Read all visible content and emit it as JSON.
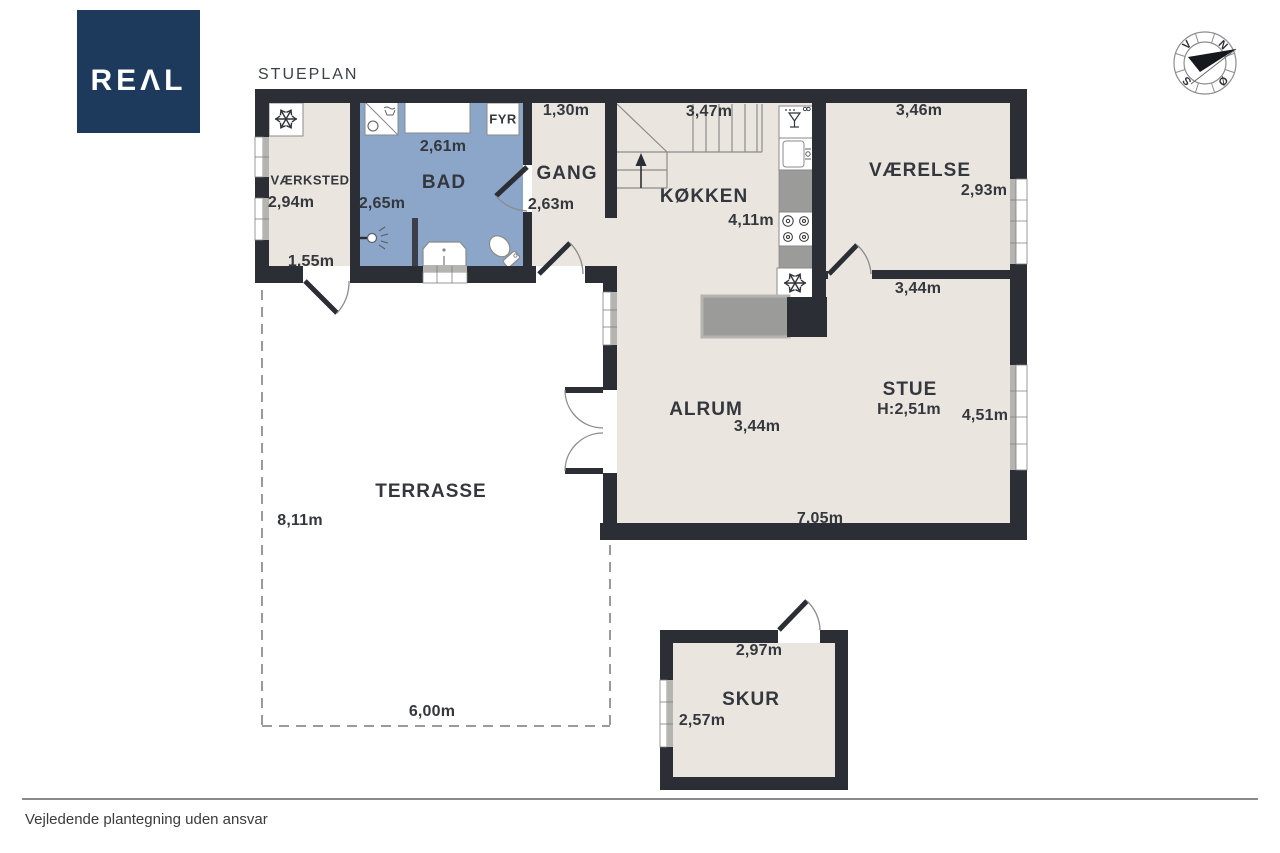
{
  "header": {
    "logo_text": "REΛL",
    "title": "STUEPLAN"
  },
  "compass": {
    "north": "N",
    "east": "Ø",
    "south": "S",
    "west": "V"
  },
  "rooms": {
    "vaerksted": {
      "name": "VÆRKSTED",
      "depth": "2,94m",
      "width": "1,55m"
    },
    "bad": {
      "name": "BAD",
      "width": "2,61m",
      "depth": "2,65m"
    },
    "fyr": {
      "name": "FYR"
    },
    "gang": {
      "name": "GANG",
      "width": "1,30m",
      "depth": "2,63m"
    },
    "koekken": {
      "name": "KØKKEN",
      "width": "3,47m",
      "depth": "4,11m"
    },
    "vaerelse": {
      "name": "VÆRELSE",
      "width": "3,46m",
      "depth": "2,93m"
    },
    "stue": {
      "name": "STUE",
      "ceiling_height": "H:2,51m",
      "width_top": "3,44m",
      "depth": "4,51m",
      "width_bottom": "7,05m"
    },
    "alrum": {
      "name": "ALRUM",
      "width": "3,44m"
    },
    "terrasse": {
      "name": "TERRASSE",
      "depth": "8,11m",
      "width": "6,00m"
    },
    "skur": {
      "name": "SKUR",
      "width": "2,97m",
      "depth": "2,57m"
    }
  },
  "footer": {
    "disclaimer": "Vejledende plantegning uden ansvar"
  },
  "colors": {
    "wall": "#2b2e35",
    "floor": "#eae6df",
    "bath_floor": "#8ba6c8",
    "counter": "#9b9b99",
    "logo_bg": "#1d3a5c",
    "text": "#34373d",
    "outline_gray": "#8b8b8b",
    "dash_gray": "#9a9a9a"
  }
}
